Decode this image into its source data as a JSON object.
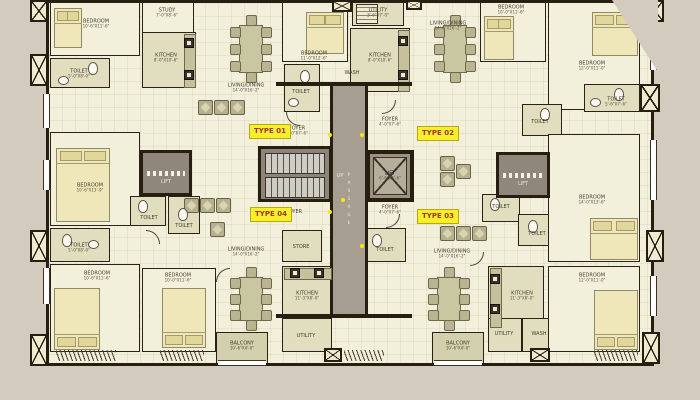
{
  "badges": {
    "t01": "TYPE 01",
    "t02": "TYPE 02",
    "t03": "TYPE 03",
    "t04": "TYPE 04"
  },
  "core": {
    "passage": "PASSAGE",
    "stairs": "UP",
    "lift": "LIFT",
    "lift_dims": "6'-6\"X6'-6\""
  },
  "colors": {
    "outside": "#d3ccbe",
    "floor": "#f2efdb",
    "floor_wet": "#e0debf",
    "wall": "#261e11",
    "core_gray": "#a69e90",
    "badge_bg": "#f7ef2b",
    "badge_text": "#a2371f",
    "dot": "#f6e70c"
  },
  "rooms": {
    "b1": {
      "n": "BEDROOM",
      "d": "10'-6\"X11'-6\""
    },
    "b2": {
      "n": "BEDROOM",
      "d": "11'-0\"X12'-6\""
    },
    "b3": {
      "n": "BEDROOM",
      "d": "10'-0\"X11'-6\""
    },
    "b4": {
      "n": "BEDROOM",
      "d": "12'-0\"X11'-0\""
    },
    "b5": {
      "n": "BEDROOM",
      "d": "10'-6\"X13'-9\""
    },
    "b6": {
      "n": "BEDROOM",
      "d": "14'-0\"X13'-6\""
    },
    "b7": {
      "n": "BEDROOM",
      "d": "10'-6\"X11'-6\""
    },
    "b8": {
      "n": "BEDROOM",
      "d": "10'-0\"X11'-6\""
    },
    "b9": {
      "n": "BEDROOM",
      "d": "12'-0\"X11'-0\""
    },
    "st1": {
      "n": "STUDY",
      "d": "7'-0\"X8'-6\""
    },
    "st2": {
      "n": "STORE",
      "d": "4'-6\"X5'-0\""
    },
    "k1": {
      "n": "KITCHEN",
      "d": "8'-0\"X10'-6\""
    },
    "k2": {
      "n": "KITCHEN",
      "d": "8'-0\"X10'-6\""
    },
    "k3": {
      "n": "KITCHEN",
      "d": "11'-3\"X8'-0\""
    },
    "k4": {
      "n": "KITCHEN",
      "d": "11'-3\"X8'-0\""
    },
    "t1": {
      "n": "TOILET",
      "d": "5'-0\"X8'-0\""
    },
    "t2": {
      "n": "TOILET",
      "d": "5'-6\"X7'-6\""
    },
    "t3": {
      "n": "TOILET",
      "d": "5'-0\"X7'-6\""
    },
    "t4": {
      "n": "TOILET",
      "d": "5'-6\"X7'-6\""
    },
    "t5": {
      "n": "TOILET",
      "d": "7'-1\"X4'-6\""
    },
    "t6": {
      "n": "TOILET",
      "d": "5'-0\"X7'-6\""
    },
    "t7": {
      "n": "TOILET",
      "d": "5'-0\"X8'-0\""
    },
    "t8": {
      "n": "TOILET",
      "d": "5'-0\"X7'-6\""
    },
    "t9": {
      "n": "TOILET",
      "d": "5'-0\"X7'-6\""
    },
    "t10": {
      "n": "TOILET",
      "d": "5'-6\"X7'-6\""
    },
    "u2": {
      "n": "UTILITY",
      "d": "3'-6\"X7'-0\""
    },
    "u3": {
      "n": "UTILITY",
      "d": "3'-6\"X8'-0\""
    },
    "u4": {
      "n": "UTILITY",
      "d": "3'-6\"X8'-0\""
    },
    "w2": {
      "n": "WASH"
    },
    "w4": {
      "n": "WASH"
    },
    "ld1": {
      "n": "LIVING/DINING",
      "d": "14'-0\"X16'-2\""
    },
    "ld2": {
      "n": "LIVING/DINING",
      "d": "14'-0\"X16'-2\""
    },
    "ld3": {
      "n": "LIVING/DINING",
      "d": "14'-0\"X16'-2\""
    },
    "ld4": {
      "n": "LIVING/DINING",
      "d": "14'-0\"X16'-2\""
    },
    "f1": {
      "n": "FOYER",
      "d": "4'-0\"X7'-6\""
    },
    "f2": {
      "n": "FOYER",
      "d": "4'-0\"X7'-6\""
    },
    "f3": {
      "n": "FOYER",
      "d": "4'-0\"X7'-6\""
    },
    "f4": {
      "n": "FOYER",
      "d": "4'-0\"X7'-6\""
    },
    "bal1": {
      "n": "BALCONY",
      "d": "10'-6\"X4'-0\""
    },
    "bal2": {
      "n": "BALCONY",
      "d": "10'-6\"X4'-0\""
    }
  }
}
